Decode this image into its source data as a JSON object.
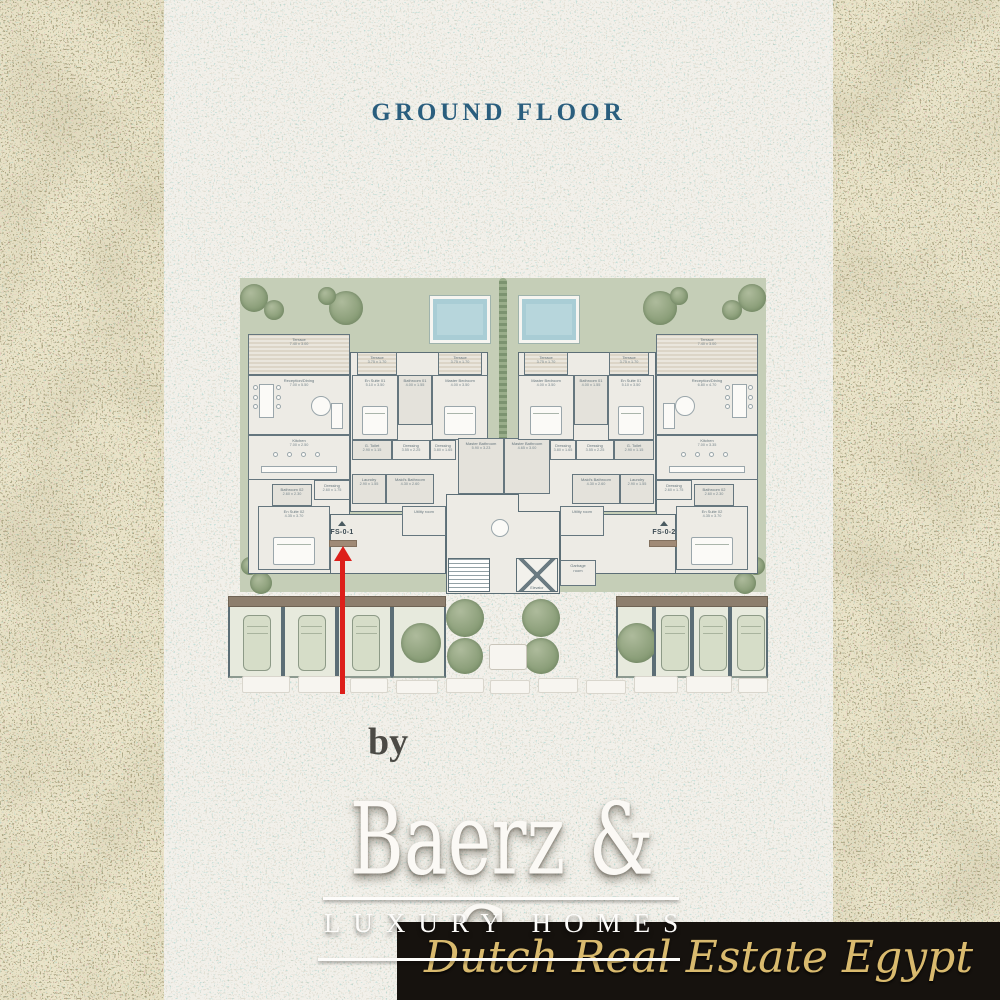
{
  "title": "GROUND FLOOR",
  "plan": {
    "garden": {
      "x": 12,
      "y": 0,
      "w": 526,
      "h": 314
    },
    "hedge": {
      "x": 271,
      "y": 0,
      "w": 8,
      "h": 168
    },
    "pools": [
      {
        "x": 202,
        "y": 18,
        "w": 60,
        "h": 47
      },
      {
        "x": 291,
        "y": 18,
        "w": 60,
        "h": 47
      }
    ],
    "garden_trees": [
      {
        "cx": 26,
        "cy": 20,
        "r": 14
      },
      {
        "cx": 46,
        "cy": 32,
        "r": 10
      },
      {
        "cx": 118,
        "cy": 30,
        "r": 17
      },
      {
        "cx": 99,
        "cy": 18,
        "r": 9
      },
      {
        "cx": 432,
        "cy": 30,
        "r": 17
      },
      {
        "cx": 451,
        "cy": 18,
        "r": 9
      },
      {
        "cx": 524,
        "cy": 20,
        "r": 14
      },
      {
        "cx": 504,
        "cy": 32,
        "r": 10
      },
      {
        "cx": 22,
        "cy": 288,
        "r": 9
      },
      {
        "cx": 33,
        "cy": 305,
        "r": 11
      },
      {
        "cx": 528,
        "cy": 288,
        "r": 9
      },
      {
        "cx": 517,
        "cy": 305,
        "r": 11
      }
    ],
    "bases": [
      {
        "x": 20,
        "y": 56,
        "w": 102,
        "h": 240
      },
      {
        "x": 122,
        "y": 74,
        "w": 138,
        "h": 160
      },
      {
        "x": 218,
        "y": 216,
        "w": 114,
        "h": 100
      },
      {
        "x": 428,
        "y": 56,
        "w": 102,
        "h": 240
      },
      {
        "x": 290,
        "y": 74,
        "w": 138,
        "h": 160
      },
      {
        "x": 102,
        "y": 236,
        "w": 116,
        "h": 60
      },
      {
        "x": 332,
        "y": 236,
        "w": 116,
        "h": 60
      }
    ],
    "rooms": [
      {
        "id": "terrace-main-l",
        "name": "Terrace",
        "dims": "7.40 x 3.00",
        "x": 20,
        "y": 56,
        "w": 102,
        "h": 41,
        "kind": "terrace"
      },
      {
        "id": "reception-l",
        "name": "Reception/Dining",
        "dims": "7.00 x 5.50",
        "x": 20,
        "y": 97,
        "w": 102,
        "h": 60,
        "kind": "room",
        "furn": "reception"
      },
      {
        "id": "kitchen-l",
        "name": "Kitchen",
        "dims": "7.00 x 2.50",
        "x": 20,
        "y": 157,
        "w": 102,
        "h": 45,
        "kind": "room",
        "furn": "kitchen"
      },
      {
        "id": "terrace-ensuite-l",
        "name": "Terrace",
        "dims": "3.75 x 1.70",
        "x": 129,
        "y": 74,
        "w": 40,
        "h": 23,
        "kind": "terrace"
      },
      {
        "id": "ensuite01-l",
        "name": "En Suite 01",
        "dims": "5.10 x 3.50",
        "x": 124,
        "y": 97,
        "w": 46,
        "h": 65,
        "kind": "room",
        "furn": "bed"
      },
      {
        "id": "bath01-l",
        "name": "Bathroom 01",
        "dims": "4.00 x 1.55",
        "x": 170,
        "y": 97,
        "w": 34,
        "h": 50,
        "kind": "wet"
      },
      {
        "id": "terrace-master-l",
        "name": "Terrace",
        "dims": "3.75 x 1.70",
        "x": 210,
        "y": 74,
        "w": 44,
        "h": 23,
        "kind": "terrace"
      },
      {
        "id": "master-l",
        "name": "Master Bedroom",
        "dims": "4.00 x 3.50",
        "x": 204,
        "y": 97,
        "w": 56,
        "h": 65,
        "kind": "room",
        "furn": "bed"
      },
      {
        "id": "gtoilet-l",
        "name": "G. Toilet",
        "dims": "2.90 x 1.15",
        "x": 124,
        "y": 162,
        "w": 40,
        "h": 20,
        "kind": "wet"
      },
      {
        "id": "dressing1-l",
        "name": "Dressing",
        "dims": "3.55 x 2.25",
        "x": 164,
        "y": 162,
        "w": 38,
        "h": 20,
        "kind": "room"
      },
      {
        "id": "dressing2-l",
        "name": "Dressing",
        "dims": "3.80 x 1.65",
        "x": 202,
        "y": 162,
        "w": 26,
        "h": 20,
        "kind": "room"
      },
      {
        "id": "masterbath-l",
        "name": "Master Bathroom",
        "dims": "5.90 x 3.23",
        "x": 230,
        "y": 160,
        "w": 46,
        "h": 56,
        "kind": "wet"
      },
      {
        "id": "laundry-l",
        "name": "Laundry",
        "dims": "2.90 x 1.55",
        "x": 124,
        "y": 196,
        "w": 34,
        "h": 30,
        "kind": "wet"
      },
      {
        "id": "maids-l",
        "name": "Maid's Bathroom",
        "dims": "4.30 x 2.60",
        "x": 158,
        "y": 196,
        "w": 48,
        "h": 30,
        "kind": "wet"
      },
      {
        "id": "utility-l",
        "name": "Utility room",
        "dims": "",
        "x": 174,
        "y": 228,
        "w": 44,
        "h": 30,
        "kind": "room"
      },
      {
        "id": "dressing3-l",
        "name": "Dressing",
        "dims": "2.60 x 1.75",
        "x": 86,
        "y": 202,
        "w": 36,
        "h": 20,
        "kind": "room"
      },
      {
        "id": "bath02-l",
        "name": "Bathroom 02",
        "dims": "2.60 x 2.30",
        "x": 44,
        "y": 206,
        "w": 40,
        "h": 22,
        "kind": "wet"
      },
      {
        "id": "ensuite02-l",
        "name": "En Suite 02",
        "dims": "4.35 x 3.70",
        "x": 30,
        "y": 228,
        "w": 72,
        "h": 64,
        "kind": "room",
        "furn": "bed"
      },
      {
        "id": "masterbath-r",
        "name": "Master Bathroom",
        "dims": "4.65 x 3.00",
        "x": 276,
        "y": 160,
        "w": 46,
        "h": 56,
        "kind": "wet"
      },
      {
        "id": "terrace-main-r",
        "name": "Terrace",
        "dims": "7.40 x 3.00",
        "x": 428,
        "y": 56,
        "w": 102,
        "h": 41,
        "kind": "terrace"
      },
      {
        "id": "reception-r",
        "name": "Reception/Dining",
        "dims": "6.80 x 4.70",
        "x": 428,
        "y": 97,
        "w": 102,
        "h": 60,
        "kind": "room",
        "furn": "reception"
      },
      {
        "id": "kitchen-r",
        "name": "Kitchen",
        "dims": "7.00 x 3.35",
        "x": 428,
        "y": 157,
        "w": 102,
        "h": 45,
        "kind": "room",
        "furn": "kitchen"
      },
      {
        "id": "terrace-ensuite-r",
        "name": "Terrace",
        "dims": "3.75 x 1.70",
        "x": 381,
        "y": 74,
        "w": 40,
        "h": 23,
        "kind": "terrace"
      },
      {
        "id": "ensuite01-r",
        "name": "En Suite 01",
        "dims": "5.10 x 3.50",
        "x": 380,
        "y": 97,
        "w": 46,
        "h": 65,
        "kind": "room",
        "furn": "bed"
      },
      {
        "id": "bath01-r",
        "name": "Bathroom 01",
        "dims": "4.00 x 1.55",
        "x": 346,
        "y": 97,
        "w": 34,
        "h": 50,
        "kind": "wet"
      },
      {
        "id": "terrace-master-r",
        "name": "Terrace",
        "dims": "3.75 x 1.70",
        "x": 296,
        "y": 74,
        "w": 44,
        "h": 23,
        "kind": "terrace"
      },
      {
        "id": "master-r",
        "name": "Master Bedroom",
        "dims": "4.00 x 3.50",
        "x": 290,
        "y": 97,
        "w": 56,
        "h": 65,
        "kind": "room",
        "furn": "bed"
      },
      {
        "id": "gtoilet-r",
        "name": "G. Toilet",
        "dims": "2.90 x 1.15",
        "x": 386,
        "y": 162,
        "w": 40,
        "h": 20,
        "kind": "wet"
      },
      {
        "id": "dressing1-r",
        "name": "Dressing",
        "dims": "3.55 x 2.25",
        "x": 348,
        "y": 162,
        "w": 38,
        "h": 20,
        "kind": "room"
      },
      {
        "id": "dressing2-r",
        "name": "Dressing",
        "dims": "3.80 x 1.65",
        "x": 322,
        "y": 162,
        "w": 26,
        "h": 20,
        "kind": "room"
      },
      {
        "id": "laundry-r",
        "name": "Laundry",
        "dims": "2.90 x 1.55",
        "x": 392,
        "y": 196,
        "w": 34,
        "h": 30,
        "kind": "wet"
      },
      {
        "id": "maids-r",
        "name": "Maid's Bathroom",
        "dims": "4.30 x 2.60",
        "x": 344,
        "y": 196,
        "w": 48,
        "h": 30,
        "kind": "wet"
      },
      {
        "id": "utility-r",
        "name": "Utility room",
        "dims": "",
        "x": 332,
        "y": 228,
        "w": 44,
        "h": 30,
        "kind": "room"
      },
      {
        "id": "dressing3-r",
        "name": "Dressing",
        "dims": "2.60 x 1.75",
        "x": 428,
        "y": 202,
        "w": 36,
        "h": 20,
        "kind": "room"
      },
      {
        "id": "bath02-r",
        "name": "Bathroom 02",
        "dims": "2.60 x 2.30",
        "x": 466,
        "y": 206,
        "w": 40,
        "h": 22,
        "kind": "wet"
      },
      {
        "id": "ensuite02-r",
        "name": "En Suite 02",
        "dims": "4.35 x 3.70",
        "x": 448,
        "y": 228,
        "w": 72,
        "h": 64,
        "kind": "room",
        "furn": "bed"
      }
    ],
    "features": {
      "stairs": {
        "x": 220,
        "y": 280,
        "w": 42,
        "h": 34
      },
      "elevator": {
        "x": 288,
        "y": 280,
        "w": 42,
        "h": 34,
        "label": "Elevator"
      },
      "garbage": {
        "x": 332,
        "y": 282,
        "w": 36,
        "h": 26,
        "label": "Garbage\nroom"
      },
      "table": {
        "cx": 272,
        "cy": 250,
        "r": 9
      }
    },
    "parking": {
      "left": {
        "x": 0,
        "y": 318,
        "w": 218,
        "h": 82,
        "bays": 4,
        "cars": [
          0,
          1,
          2
        ],
        "tree": 3
      },
      "right": {
        "x": 388,
        "y": 318,
        "w": 152,
        "h": 82,
        "bays": 4,
        "cars": [
          1,
          2,
          3
        ],
        "tree": 0
      }
    },
    "courtyard_trees": [
      {
        "cx": 237,
        "cy": 340,
        "r": 19
      },
      {
        "cx": 237,
        "cy": 378,
        "r": 18
      },
      {
        "cx": 313,
        "cy": 340,
        "r": 19
      },
      {
        "cx": 313,
        "cy": 378,
        "r": 18
      }
    ],
    "bench": {
      "x": 261,
      "y": 366,
      "w": 38,
      "h": 26
    },
    "stones": [
      {
        "x": 14,
        "y": 398,
        "w": 48,
        "h": 17
      },
      {
        "x": 70,
        "y": 398,
        "w": 44,
        "h": 17
      },
      {
        "x": 122,
        "y": 400,
        "w": 38,
        "h": 15
      },
      {
        "x": 168,
        "y": 402,
        "w": 42,
        "h": 14
      },
      {
        "x": 218,
        "y": 400,
        "w": 38,
        "h": 15
      },
      {
        "x": 262,
        "y": 402,
        "w": 40,
        "h": 14
      },
      {
        "x": 310,
        "y": 400,
        "w": 40,
        "h": 15
      },
      {
        "x": 358,
        "y": 402,
        "w": 40,
        "h": 14
      },
      {
        "x": 406,
        "y": 398,
        "w": 44,
        "h": 17
      },
      {
        "x": 458,
        "y": 398,
        "w": 46,
        "h": 17
      },
      {
        "x": 510,
        "y": 400,
        "w": 30,
        "h": 15
      }
    ],
    "arrow": {
      "x": 112,
      "y_head": 268,
      "y_tail": 416,
      "w": 5,
      "color": "#dd1f1a"
    },
    "unit_labels": [
      {
        "text": "FS-0-1",
        "x": 90,
        "y": 251,
        "w": 48
      },
      {
        "text": "FS-0-2",
        "x": 412,
        "y": 251,
        "w": 48
      }
    ],
    "doormats": [
      {
        "x": 101,
        "y": 262,
        "w": 28,
        "h": 7
      },
      {
        "x": 421,
        "y": 262,
        "w": 28,
        "h": 7
      }
    ]
  },
  "specs": {
    "accent": "#2b6477",
    "groups": [
      {
        "bedrooms": "3 Bedroom",
        "columns": [
          {
            "label": "BUA",
            "value": "282sqm",
            "cx": 258,
            "w": 84
          },
          {
            "label": "Terraces",
            "value": "40 sqm",
            "cx": 345,
            "w": 96
          },
          {
            "label": "Gardens",
            "value": "160sqm",
            "cx": 428,
            "w": 100
          }
        ]
      },
      {
        "bedrooms": "3 Bedroom",
        "columns": [
          {
            "label": "BUA",
            "value": "282sqm",
            "cx": 557,
            "w": 84
          },
          {
            "label": "Terraces",
            "value": "40 sqm",
            "cx": 645,
            "w": 96
          },
          {
            "label": "Gardens",
            "value": "160 sqm",
            "cx": 726,
            "w": 100
          }
        ]
      }
    ],
    "short_separators": [
      298,
      378,
      595,
      674
    ],
    "center_separator": 488
  },
  "watermark": {
    "by": "by",
    "brand": "Baerz & Co",
    "tagline": "LUXURY HOMES"
  },
  "banner": {
    "text": "Dutch Real Estate Egypt",
    "gold": "#d9ba6e",
    "bg": "#16120e"
  }
}
